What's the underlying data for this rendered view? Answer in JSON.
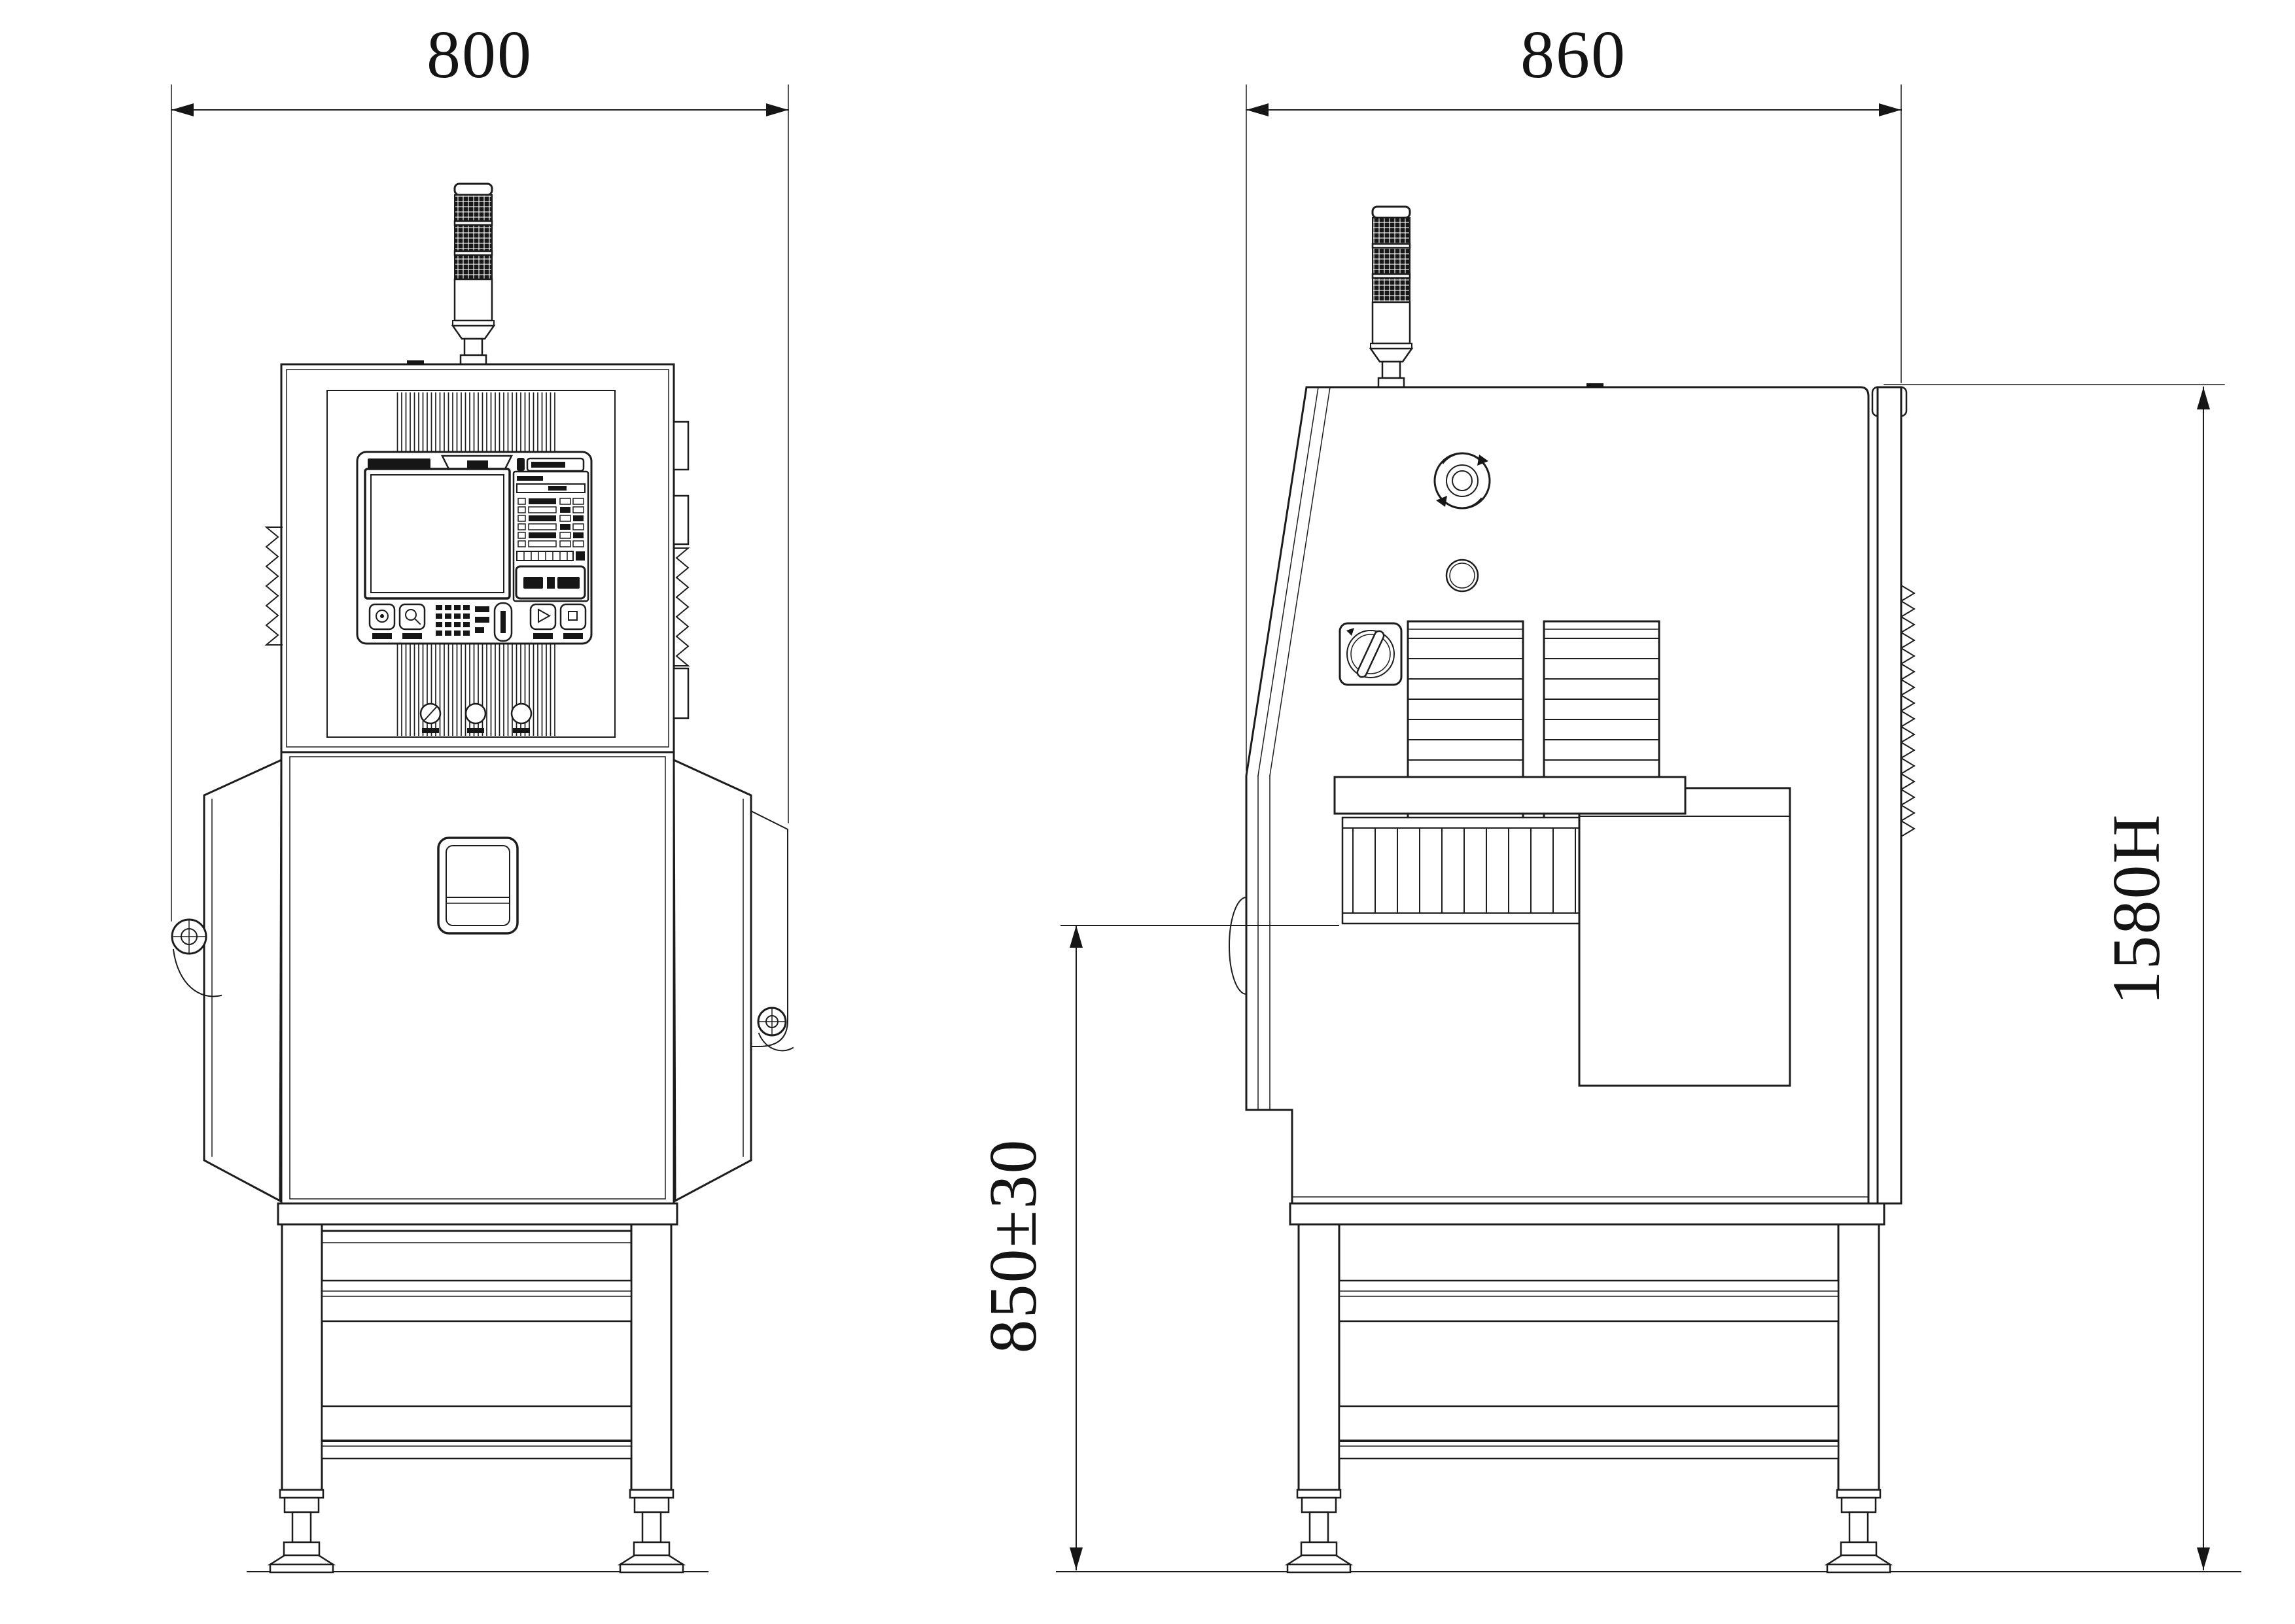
{
  "drawing": {
    "title_visible_text": [],
    "colors": {
      "background": "#ffffff",
      "line": "#1c1c1c"
    },
    "dims": {
      "front_width": "800",
      "side_width": "860",
      "overall_height": "1580H",
      "belt_height": "850±30"
    },
    "views": {
      "front": {
        "id": "front-view",
        "components": [
          "signal-tower",
          "control-cabinet",
          "control-panel",
          "touch-screen",
          "status-panel",
          "button-row",
          "key-switch",
          "push-buttons",
          "door-handle",
          "side-wings",
          "clamp-knobs",
          "stand-frame",
          "leveling-feet",
          "heatsink-fins",
          "terminal-blocks"
        ],
        "signal_tower_segments": 3,
        "panel_buttons": 4,
        "lower_push_buttons": 3,
        "legs": 2
      },
      "side": {
        "id": "side-view",
        "components": [
          "signal-tower",
          "emergency-stop",
          "indicator-port",
          "rotary-switch",
          "vent-grille",
          "vent-grille",
          "slanted-front-door",
          "shield-curtain",
          "conveyor-top-plate",
          "side-access-box",
          "rear-panel-strip",
          "heatsink-fins",
          "stand-frame",
          "leveling-feet"
        ],
        "signal_tower_segments": 3,
        "vent_grilles": 2,
        "curtain_slats": 12,
        "legs": 2
      }
    }
  }
}
